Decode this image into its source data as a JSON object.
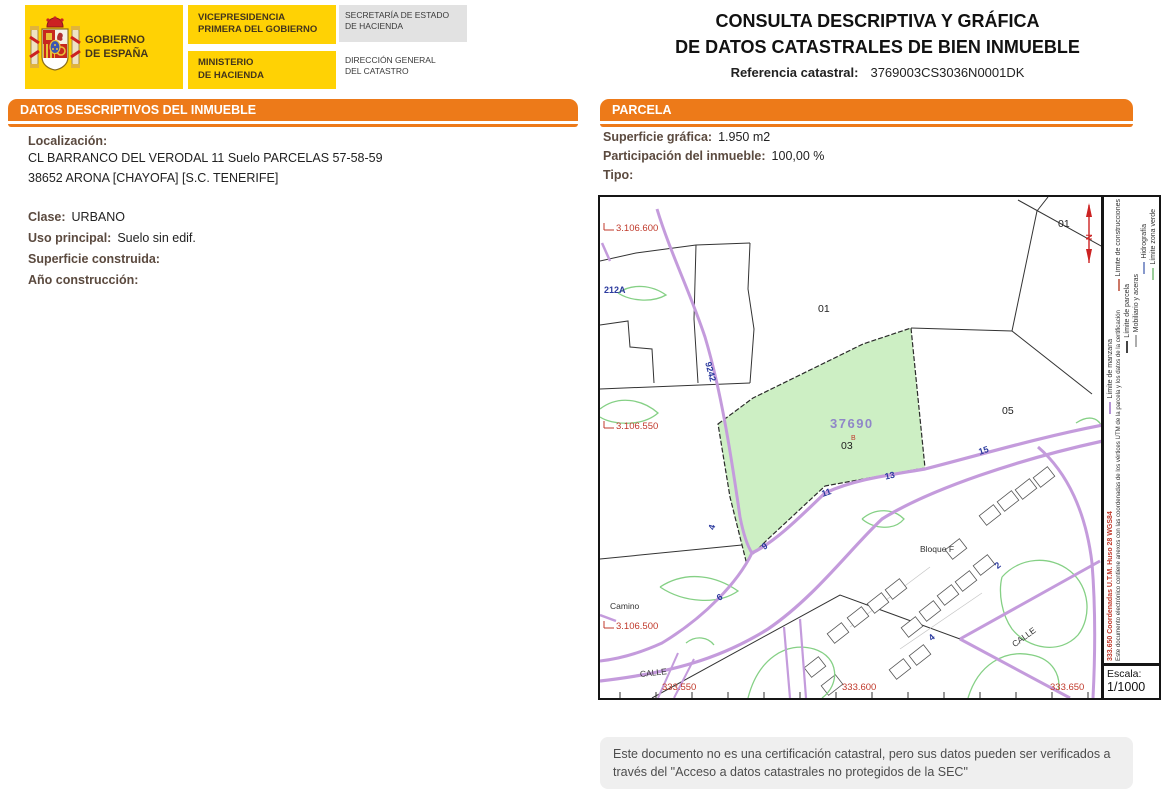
{
  "colors": {
    "accent_orange": "#ED7A19",
    "brand_yellow": "#FFD204",
    "label_brown": "#5B4A3F",
    "road_purple": "#C49BDC",
    "parcel_green_fill": "#CDEFC4",
    "coord_red": "#C0392B",
    "street_number_blue": "#2B3A9E"
  },
  "header": {
    "gobierno": "GOBIERNO\nDE ESPAÑA",
    "vicepresidencia": "VICEPRESIDENCIA\nPRIMERA DEL GOBIERNO",
    "ministerio": "MINISTERIO\nDE HACIENDA",
    "secretaria": "SECRETARÍA DE ESTADO\nDE HACIENDA",
    "direccion": "DIRECCIÓN GENERAL\nDEL CATASTRO",
    "title_line1": "CONSULTA DESCRIPTIVA Y GRÁFICA",
    "title_line2": "DE DATOS CATASTRALES DE BIEN INMUEBLE",
    "ref_label": "Referencia catastral:",
    "ref_value": "3769003CS3036N0001DK"
  },
  "left_section": {
    "title": "DATOS DESCRIPTIVOS DEL INMUEBLE",
    "localizacion_label": "Localización:",
    "address_line1": "CL BARRANCO DEL VERODAL 11 Suelo PARCELAS 57-58-59",
    "address_line2": "38652 ARONA [CHAYOFA] [S.C. TENERIFE]",
    "fields": [
      {
        "label": "Clase:",
        "value": "URBANO"
      },
      {
        "label": "Uso principal:",
        "value": "Suelo sin edif."
      },
      {
        "label": "Superficie construida:",
        "value": ""
      },
      {
        "label": "Año construcción:",
        "value": ""
      }
    ]
  },
  "parcela_section": {
    "title": "PARCELA",
    "fields": [
      {
        "label": "Superficie gráfica:",
        "value": "1.950 m2"
      },
      {
        "label": "Participación del inmueble:",
        "value": "100,00 %"
      },
      {
        "label": "Tipo:",
        "value": ""
      }
    ]
  },
  "map": {
    "y_coords": [
      "3.106.600",
      "3.106.550",
      "3.106.500"
    ],
    "x_coords": [
      "333.550",
      "333.600",
      "333.650"
    ],
    "labels": {
      "parcel_big": "01",
      "parcel_top_right": "01",
      "parcel_right": "05",
      "parcel_left": "212A",
      "subject_manzana": "37690",
      "subject_parcela": "03",
      "subject_flag": "B",
      "road_code": "9242",
      "bloque": "Bloque F",
      "camino": "Camino",
      "calle_left": "CALLE",
      "calle_right": "CALLE",
      "north": "N"
    },
    "street_numbers": [
      "4",
      "9",
      "11",
      "13",
      "15",
      "6",
      "2",
      "4"
    ],
    "escala_label": "Escala:",
    "escala_value": "1/1000"
  },
  "sidebar": {
    "legend": [
      {
        "name": "Límite de manzana",
        "color": "#B694D6"
      },
      {
        "name": "Límite de construcciones",
        "color": "#CC7766"
      },
      {
        "name": "Límite de parcela",
        "color": "#444444"
      },
      {
        "name": "Mobiliario y aceras",
        "color": "#ADADAD"
      },
      {
        "name": "Hidrografía",
        "color": "#8899CC"
      },
      {
        "name": "Límite zona verde",
        "color": "#99CC99"
      }
    ],
    "coords_note": "333.650 Coordenadas U.T.M. Huso 28 WGS84",
    "cert_note": "Este documento electrónico contiene anexos con las coordenadas de los vértices UTM de la parcela y los datos de la certificación"
  },
  "footer": {
    "disclaimer": "Este documento no es una certificación catastral, pero sus datos pueden ser verificados a través del \"Acceso a datos catastrales no protegidos de la SEC\""
  }
}
